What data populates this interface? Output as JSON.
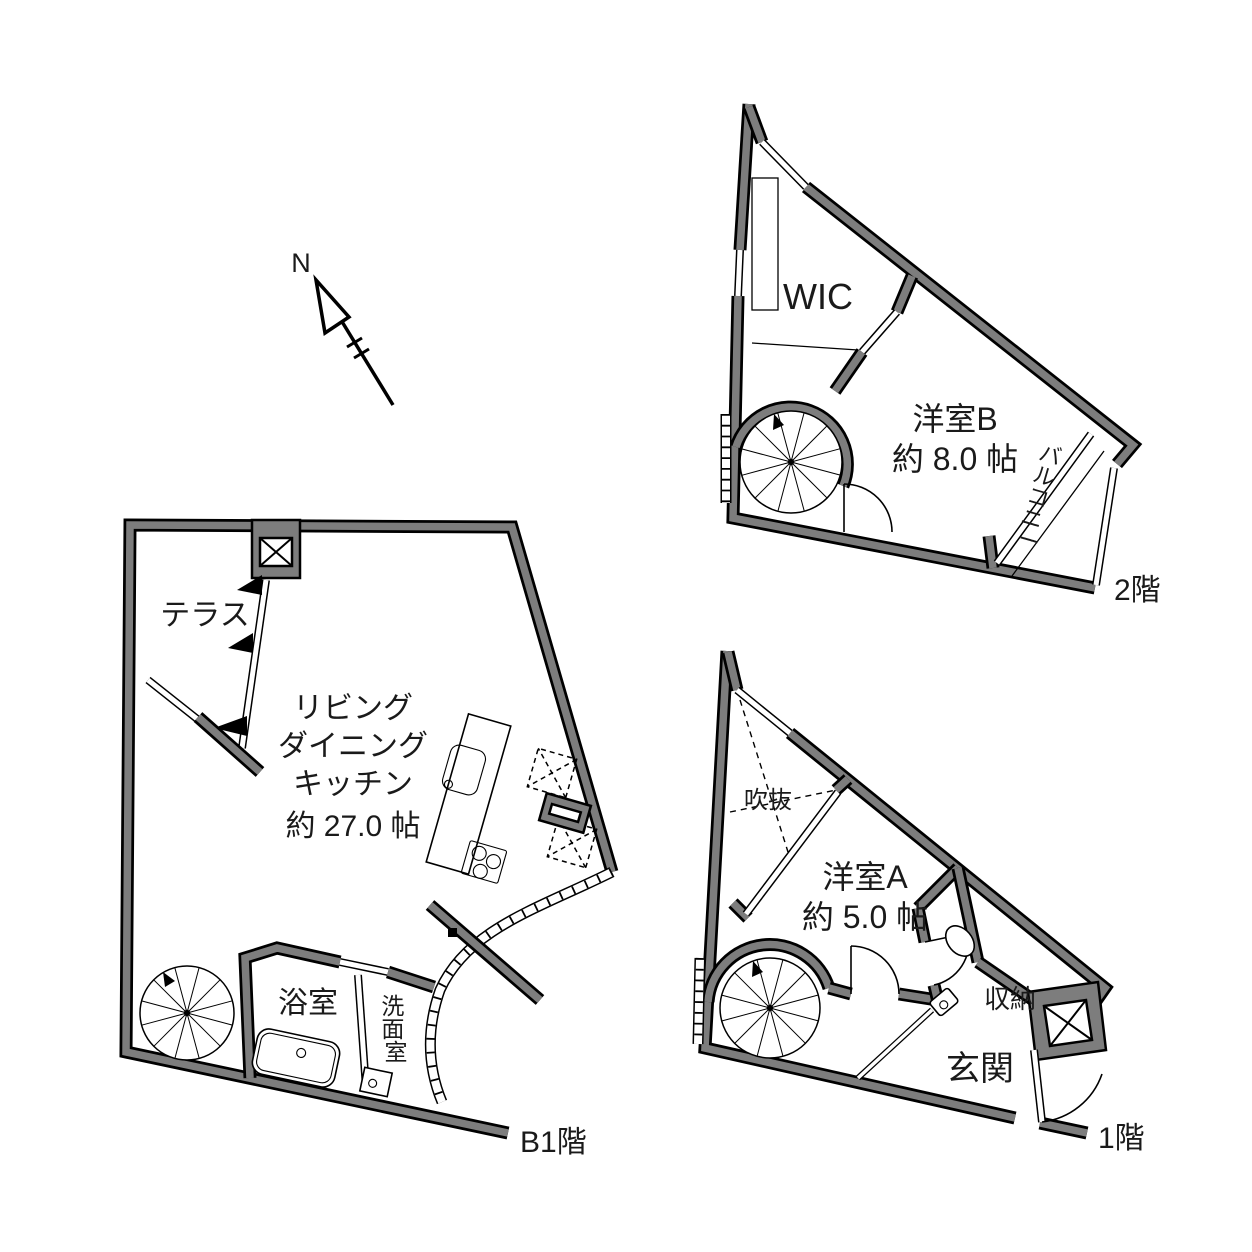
{
  "compass": {
    "north_label": "N"
  },
  "b1": {
    "floor_label": "B1階",
    "terrace": "テラス",
    "ldk_lines": [
      "リビング",
      "ダイニング",
      "キッチン",
      "約 27.0 帖"
    ],
    "bath": "浴室",
    "washroom_chars": [
      "洗",
      "面",
      "室"
    ]
  },
  "f1": {
    "floor_label": "1階",
    "void": "吹抜",
    "room_a_lines": [
      "洋室A",
      "約 5.0 帖"
    ],
    "storage": "収納",
    "entrance": "玄関"
  },
  "f2": {
    "floor_label": "2階",
    "wic": "WIC",
    "room_b_lines": [
      "洋室B",
      "約 8.0 帖"
    ],
    "balcony_chars": [
      "バ",
      "ル",
      "コ",
      "ニ",
      "ー"
    ]
  },
  "colors": {
    "wall_gray": "#7d7d7d",
    "line_black": "#000000",
    "background": "#ffffff"
  }
}
